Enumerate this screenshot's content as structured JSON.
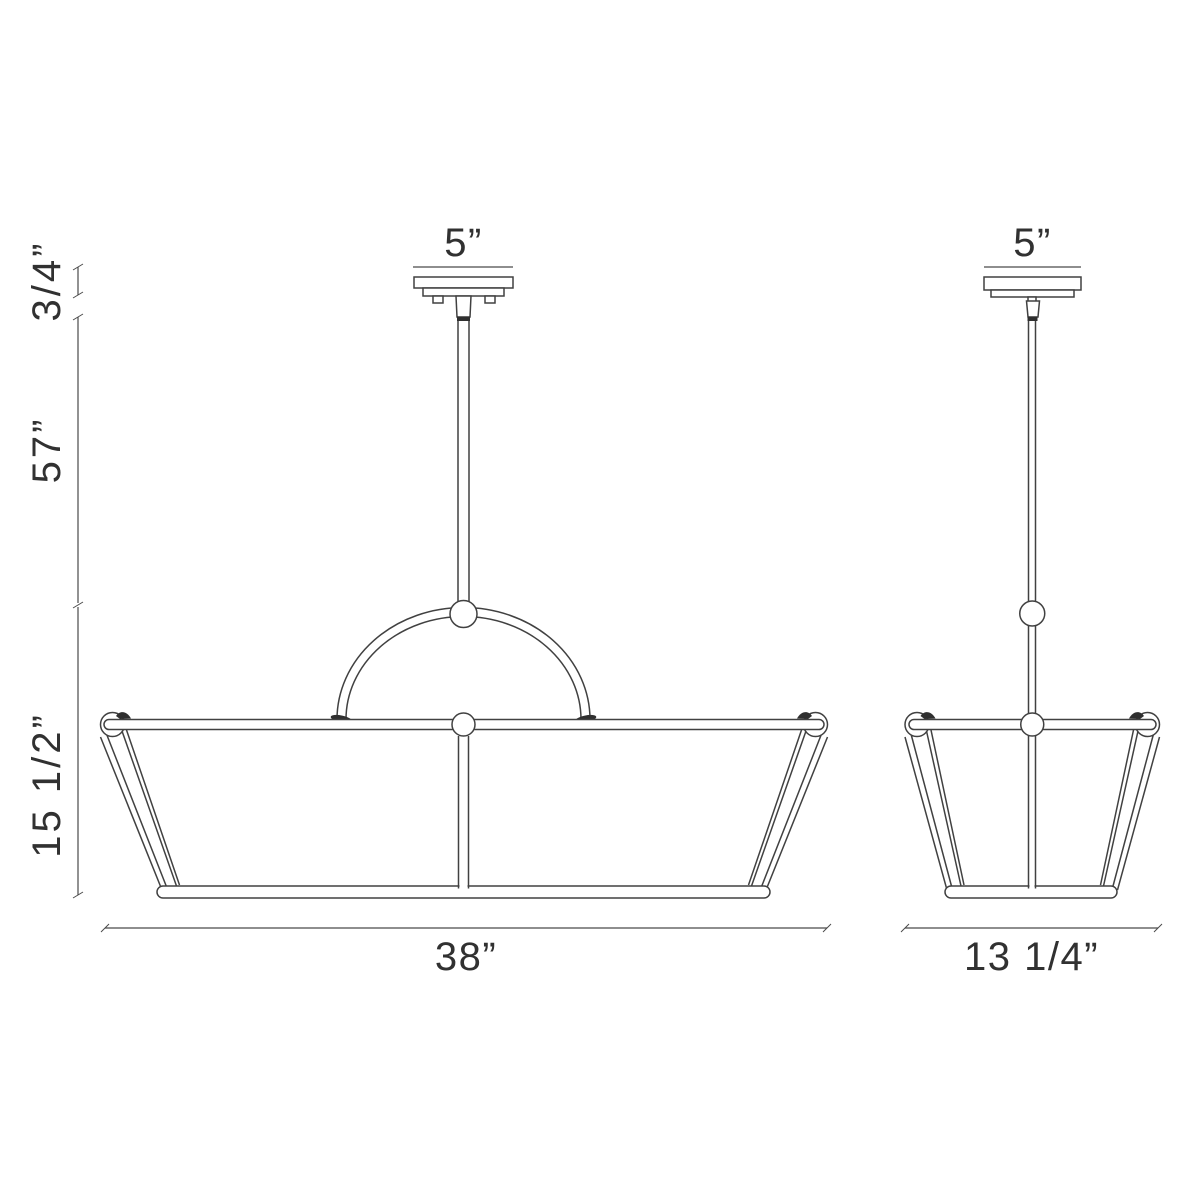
{
  "drawing": {
    "kind": "pendant-light-fixture-dimension-diagram",
    "colors": {
      "background": "#ffffff",
      "line": "#414141",
      "text": "#313131",
      "solid_fill": "#2f2f2f"
    },
    "front_view": {
      "canopy_width_label": "5”",
      "width_label": "38”"
    },
    "side_view": {
      "canopy_width_label": "5”",
      "width_label": "13 1/4”"
    },
    "height_labels": {
      "canopy": "3/4”",
      "rod": "57”",
      "shade": "15 1/2”"
    }
  }
}
